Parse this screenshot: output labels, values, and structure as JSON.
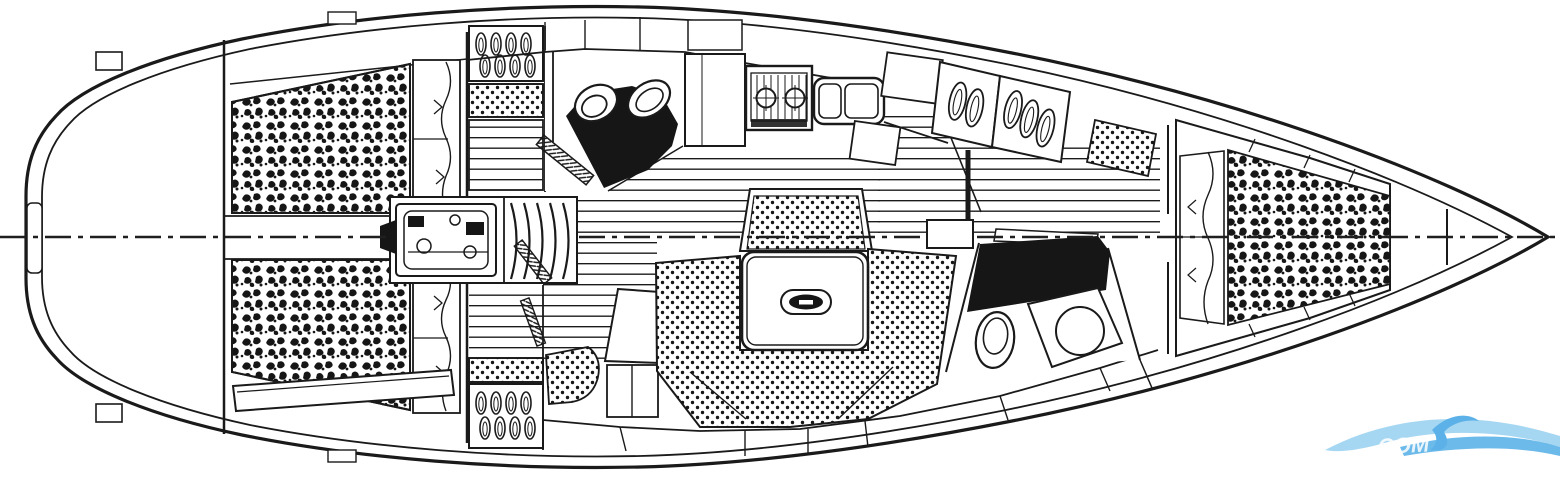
{
  "meta": {
    "type": "technical-floor-plan",
    "subject": "sailing-yacht-interior-layout-top-view",
    "orientation": {
      "bow": "right",
      "stern": "left"
    },
    "drawing_style": "black-line-drawing-on-white"
  },
  "canvas": {
    "width": 1560,
    "height": 478,
    "background": "#ffffff",
    "line_color": "#1a1a1a"
  },
  "centerline": {
    "style": "dash-dot",
    "position": "horizontal-middle"
  },
  "areas": [
    {
      "id": "aft-cabin",
      "features": [
        "double-berth-mattress",
        "pillows",
        "side-bench"
      ]
    },
    {
      "id": "aft-head",
      "features": [
        "toilet-icon",
        "washbasin-icon",
        "door-leaf"
      ]
    },
    {
      "id": "aft-wardrobe",
      "features": [
        "hanging-locker-icon",
        "seat-cushion",
        "dresser-shelves"
      ]
    },
    {
      "id": "companionway",
      "features": [
        "ladder-steps-icon",
        "engine-icon"
      ]
    },
    {
      "id": "galley",
      "features": [
        "two-burner-stove-icon",
        "double-sink-icon",
        "refrigerator-counter",
        "lockers"
      ]
    },
    {
      "id": "saloon",
      "features": [
        "u-shaped-settee",
        "dining-table",
        "table-handle",
        "bench-settee"
      ]
    },
    {
      "id": "nav-station",
      "features": [
        "seat-cushion",
        "chart-table",
        "stowage-locker",
        "hanging-locker-icon"
      ]
    },
    {
      "id": "mast-step",
      "features": [
        "compression-post"
      ]
    },
    {
      "id": "forward-head",
      "features": [
        "toilet-icon",
        "washbasin-icon",
        "vanity-counter"
      ]
    },
    {
      "id": "forward-lockers",
      "features": [
        "hanging-locker-icon",
        "hanging-locker-icon",
        "seat-cushion"
      ]
    },
    {
      "id": "forward-cabin",
      "features": [
        "v-berth-mattress",
        "pillows"
      ]
    },
    {
      "id": "bow",
      "features": [
        "anchor-locker-bulkheads"
      ]
    }
  ],
  "watermark": {
    "visible_text": "COM",
    "wave_light": "#a6d7f2",
    "wave_mid": "#5cb2e8",
    "text_color": "#ffffff"
  }
}
